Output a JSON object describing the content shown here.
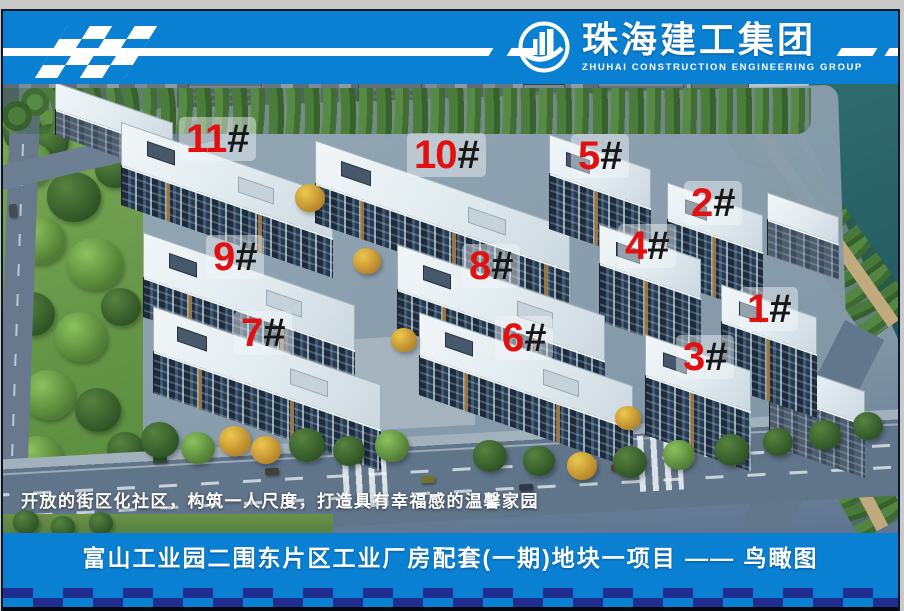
{
  "header": {
    "brand_cn": "珠海建工集团",
    "brand_en": "ZHUHAI  CONSTRUCTION  ENGINEERING  GROUP"
  },
  "scene": {
    "slogan": "开放的街区化社区，构筑一人尺度，打造具有幸福感的温馨家园",
    "buildings": [
      {
        "num": "11",
        "suffix": "#"
      },
      {
        "num": "10",
        "suffix": "#"
      },
      {
        "num": "5",
        "suffix": "#"
      },
      {
        "num": "2",
        "suffix": "#"
      },
      {
        "num": "4",
        "suffix": "#"
      },
      {
        "num": "9",
        "suffix": "#"
      },
      {
        "num": "8",
        "suffix": "#"
      },
      {
        "num": "1",
        "suffix": "#"
      },
      {
        "num": "7",
        "suffix": "#"
      },
      {
        "num": "6",
        "suffix": "#"
      },
      {
        "num": "3",
        "suffix": "#"
      }
    ]
  },
  "footer": {
    "title": "富山工业园二围东片区工业厂房配套(一期)地块一项目 —— 鸟瞰图"
  },
  "colors": {
    "header_blue": "#0a80d2",
    "checker_navy": "#1f2e90",
    "label_red": "#e21010",
    "water_teal": "#2e6b6e"
  }
}
